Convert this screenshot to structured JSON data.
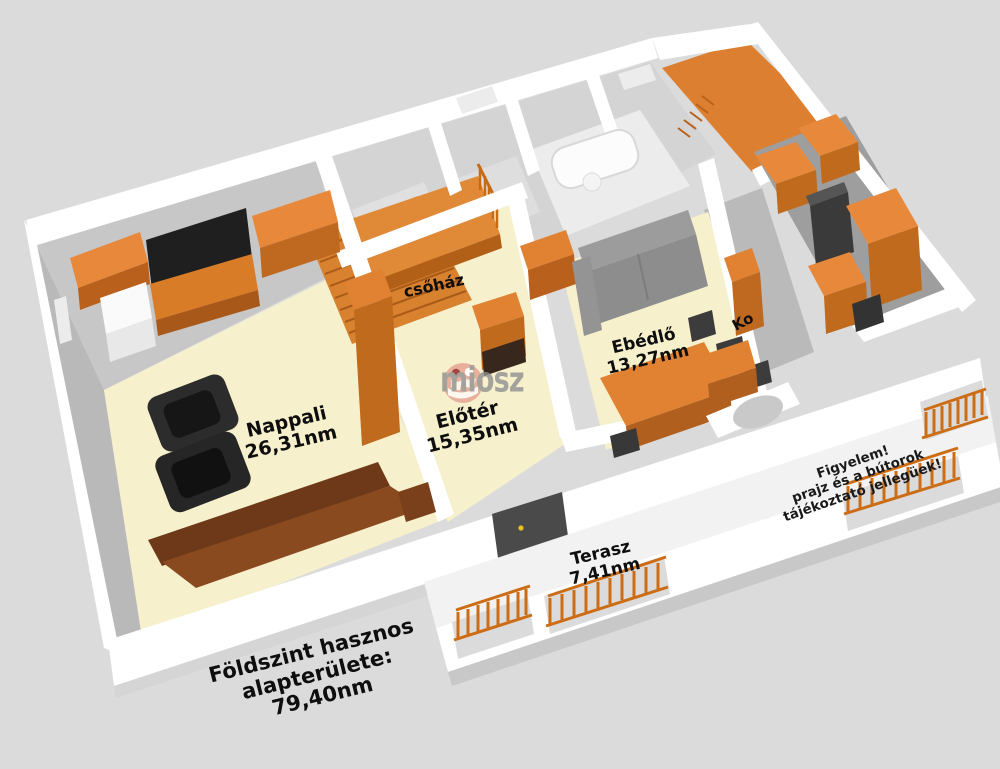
{
  "scene": {
    "background_color": "#dbdbdb",
    "wall_color": "#ffffff",
    "floor_color": "#f6f0cc",
    "accent_orange": "#e08232",
    "kitchen_floor_color": "#9f9f9f",
    "label_color": "#0e0e0e"
  },
  "rooms": [
    {
      "id": "nappali",
      "name": "Nappali",
      "area": "26,31nm"
    },
    {
      "id": "eloter",
      "name": "Előtér",
      "area": "15,35nm"
    },
    {
      "id": "lepcsohaz",
      "name": "csőház",
      "area": ""
    },
    {
      "id": "ebedlo",
      "name": "Ebédlő",
      "area": "13,27nm"
    },
    {
      "id": "konyha",
      "name": "Ko",
      "area": ""
    },
    {
      "id": "terasz",
      "name": "Terasz",
      "area": "7,41nm"
    }
  ],
  "summary": {
    "line1": "Földszint hasznos",
    "line2": "alapterülete:",
    "line3": "79,40nm"
  },
  "disclaimer": {
    "line1": "Figyelem!",
    "line2": "prajz és a bútorok",
    "line3": "tájékoztató jellegüek!"
  },
  "watermark": {
    "text": "miosz"
  }
}
